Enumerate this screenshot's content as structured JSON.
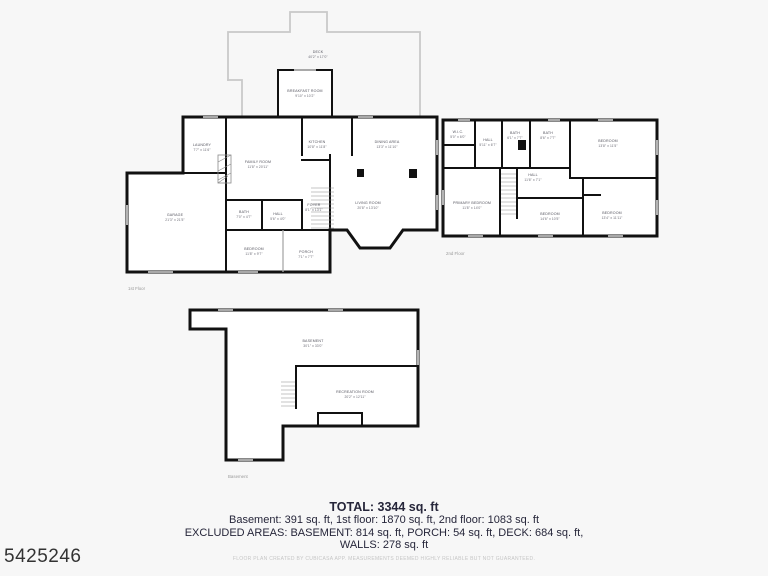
{
  "page": {
    "colors": {
      "background": "#f7f7f7",
      "wall": "#111111",
      "deck_outline": "#c9c9c9",
      "summary_text": "#26263a",
      "watermark_text": "#333333"
    }
  },
  "watermark": "5425246",
  "summary": {
    "total": "TOTAL: 3344 sq. ft",
    "breakdown": "Basement: 391 sq. ft, 1st floor: 1870 sq. ft, 2nd floor: 1083 sq. ft",
    "excluded": "EXCLUDED AREAS: BASEMENT: 814 sq. ft, PORCH: 54 sq. ft, DECK: 684 sq. ft,",
    "walls": "WALLS: 278 sq. ft",
    "disclaimer": "FLOOR PLAN CREATED BY CUBICASA APP. MEASUREMENTS DEEMED HIGHLY RELIABLE BUT NOT GUARANTEED."
  },
  "floors": [
    {
      "caption": "1st Floor",
      "rooms": [
        {
          "name": "DECK",
          "dims": "40'2\" x 17'0\""
        },
        {
          "name": "BREAKFAST ROOM",
          "dims": "9'10\" x 10'2\""
        },
        {
          "name": "LAUNDRY",
          "dims": "7'7\" x 11'6\""
        },
        {
          "name": "FAMILY ROOM",
          "dims": "11'8\" x 20'11\""
        },
        {
          "name": "KITCHEN",
          "dims": "10'8\" x 11'8\""
        },
        {
          "name": "DINING AREA",
          "dims": "13'3\" x 11'10\""
        },
        {
          "name": "FOYER",
          "dims": "8'1\" x 13'1\""
        },
        {
          "name": "LIVING ROOM",
          "dims": "20'8\" x 13'10\""
        },
        {
          "name": "GARAGE",
          "dims": "21'3\" x 21'5\""
        },
        {
          "name": "BATH",
          "dims": "7'0\" x 4'7\""
        },
        {
          "name": "HALL",
          "dims": "5'6\" x 4'0\""
        },
        {
          "name": "BEDROOM",
          "dims": "11'8\" x 9'7\""
        },
        {
          "name": "PORCH",
          "dims": "7'1\" x 7'7\""
        }
      ]
    },
    {
      "caption": "2nd Floor",
      "rooms": [
        {
          "name": "W.I.C.",
          "dims": "5'0\" x 6'0\""
        },
        {
          "name": "HALL",
          "dims": "5'11\" x 6'7\""
        },
        {
          "name": "BATH",
          "dims": "6'1\" x 7'7\""
        },
        {
          "name": "BATH",
          "dims": "8'6\" x 7'7\""
        },
        {
          "name": "BEDROOM",
          "dims": "13'8\" x 11'5\""
        },
        {
          "name": "PRIMARY BEDROOM",
          "dims": "11'8\" x 14'0\""
        },
        {
          "name": "HALL",
          "dims": "11'6\" x 7'1\""
        },
        {
          "name": "BEDROOM",
          "dims": "14'6\" x 10'5\""
        },
        {
          "name": "BEDROOM",
          "dims": "13'4\" x 11'11\""
        }
      ]
    },
    {
      "caption": "Basement",
      "rooms": [
        {
          "name": "BASEMENT",
          "dims": "30'1\" x 33'0\""
        },
        {
          "name": "RECREATION ROOM",
          "dims": "20'2\" x 12'11\""
        }
      ]
    }
  ]
}
